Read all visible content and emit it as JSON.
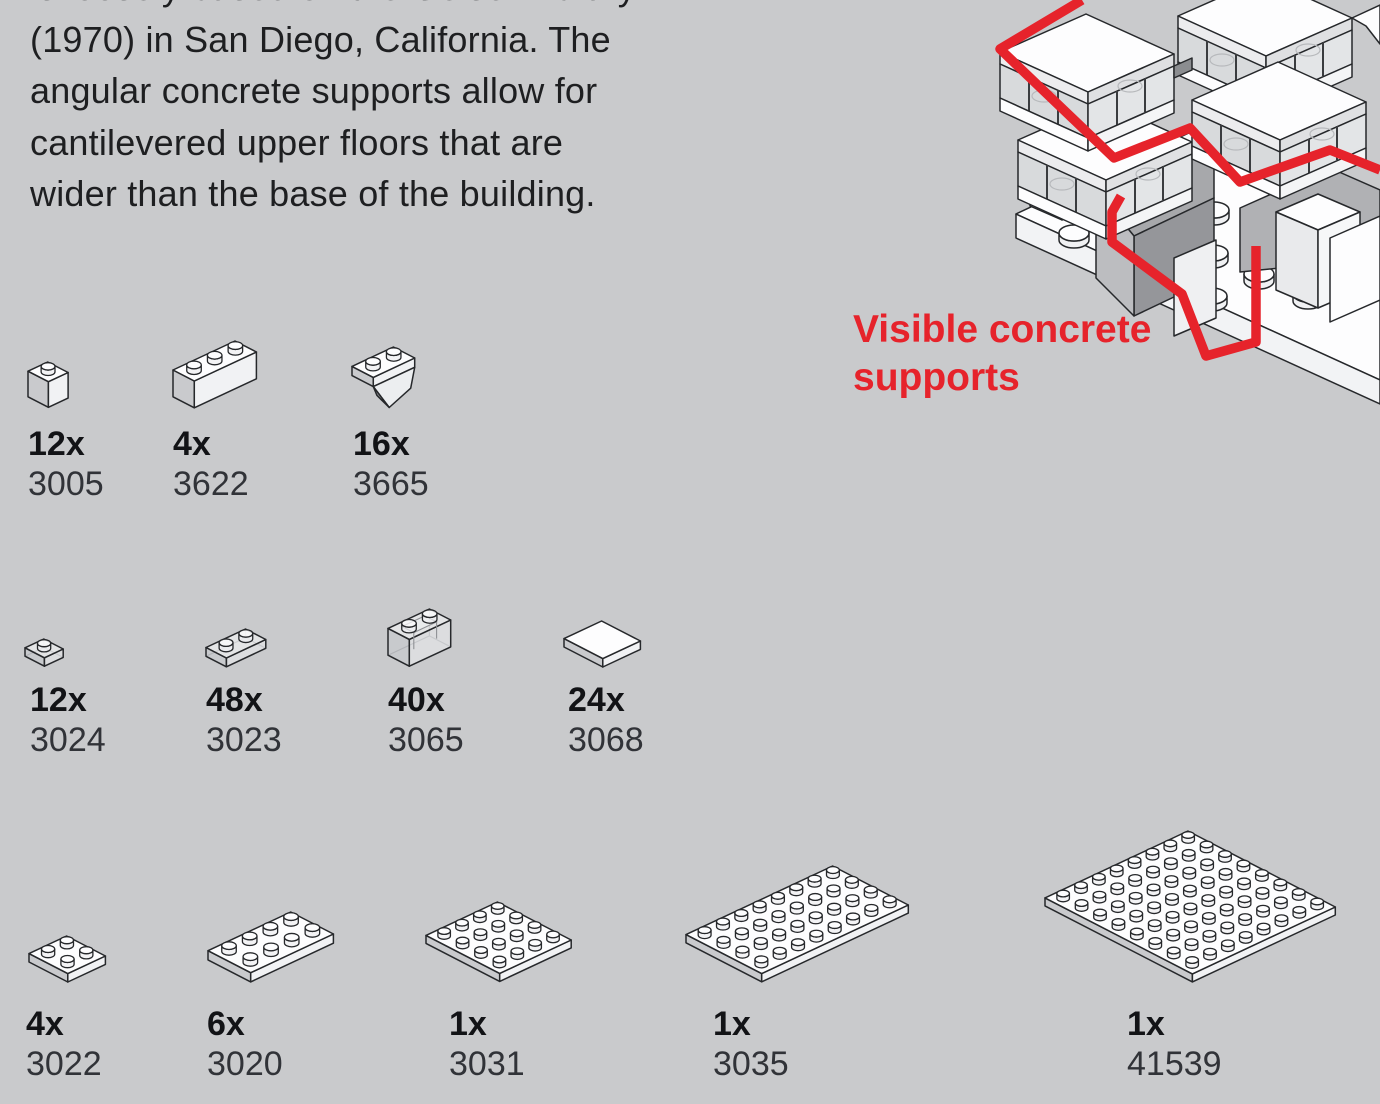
{
  "page": {
    "background": "#c9cacc",
    "accent_red": "#e6232b"
  },
  "description": {
    "text": "is loosely based on the Geisel Library\n(1970) in San Diego, California. The\nangular concrete supports allow for\ncantilevered upper floors that are\nwider than the base of the building."
  },
  "callout": {
    "text": "Visible concrete\nsupports",
    "color": "#e6232b"
  },
  "illustration": {
    "name": "lego-building-isometric",
    "highlight_color": "#e6232b"
  },
  "parts": {
    "rows": [
      {
        "items": [
          {
            "qty": "12x",
            "part": "3005",
            "shape": {
              "kind": "brick",
              "cols": 1,
              "rows": 1,
              "u": 21
            }
          },
          {
            "qty": "4x",
            "part": "3622",
            "shape": {
              "kind": "brick",
              "cols": 3,
              "rows": 1,
              "u": 22
            }
          },
          {
            "qty": "16x",
            "part": "3665",
            "shape": {
              "kind": "slope",
              "cols": 2,
              "rows": 1,
              "u": 22
            }
          }
        ]
      },
      {
        "items": [
          {
            "qty": "12x",
            "part": "3024",
            "shape": {
              "kind": "plate",
              "cols": 1,
              "rows": 1,
              "u": 20,
              "transparent": true
            }
          },
          {
            "qty": "48x",
            "part": "3023",
            "shape": {
              "kind": "plate",
              "cols": 2,
              "rows": 1,
              "u": 21,
              "transparent": true
            }
          },
          {
            "qty": "40x",
            "part": "3065",
            "shape": {
              "kind": "window",
              "cols": 2,
              "rows": 1,
              "u": 22,
              "transparent": true
            }
          },
          {
            "qty": "24x",
            "part": "3068",
            "shape": {
              "kind": "tile",
              "cols": 2,
              "rows": 2,
              "u": 20
            }
          }
        ]
      },
      {
        "items": [
          {
            "qty": "4x",
            "part": "3022",
            "shape": {
              "kind": "plate",
              "cols": 2,
              "rows": 2,
              "u": 20
            }
          },
          {
            "qty": "6x",
            "part": "3020",
            "shape": {
              "kind": "plate",
              "cols": 4,
              "rows": 2,
              "u": 22
            }
          },
          {
            "qty": "1x",
            "part": "3031",
            "shape": {
              "kind": "plate",
              "cols": 4,
              "rows": 4,
              "u": 19
            }
          },
          {
            "qty": "1x",
            "part": "3035",
            "shape": {
              "kind": "plate",
              "cols": 8,
              "rows": 4,
              "u": 19.5
            }
          },
          {
            "qty": "1x",
            "part": "41539",
            "shape": {
              "kind": "plate",
              "cols": 8,
              "rows": 8,
              "u": 19
            }
          }
        ]
      }
    ]
  }
}
